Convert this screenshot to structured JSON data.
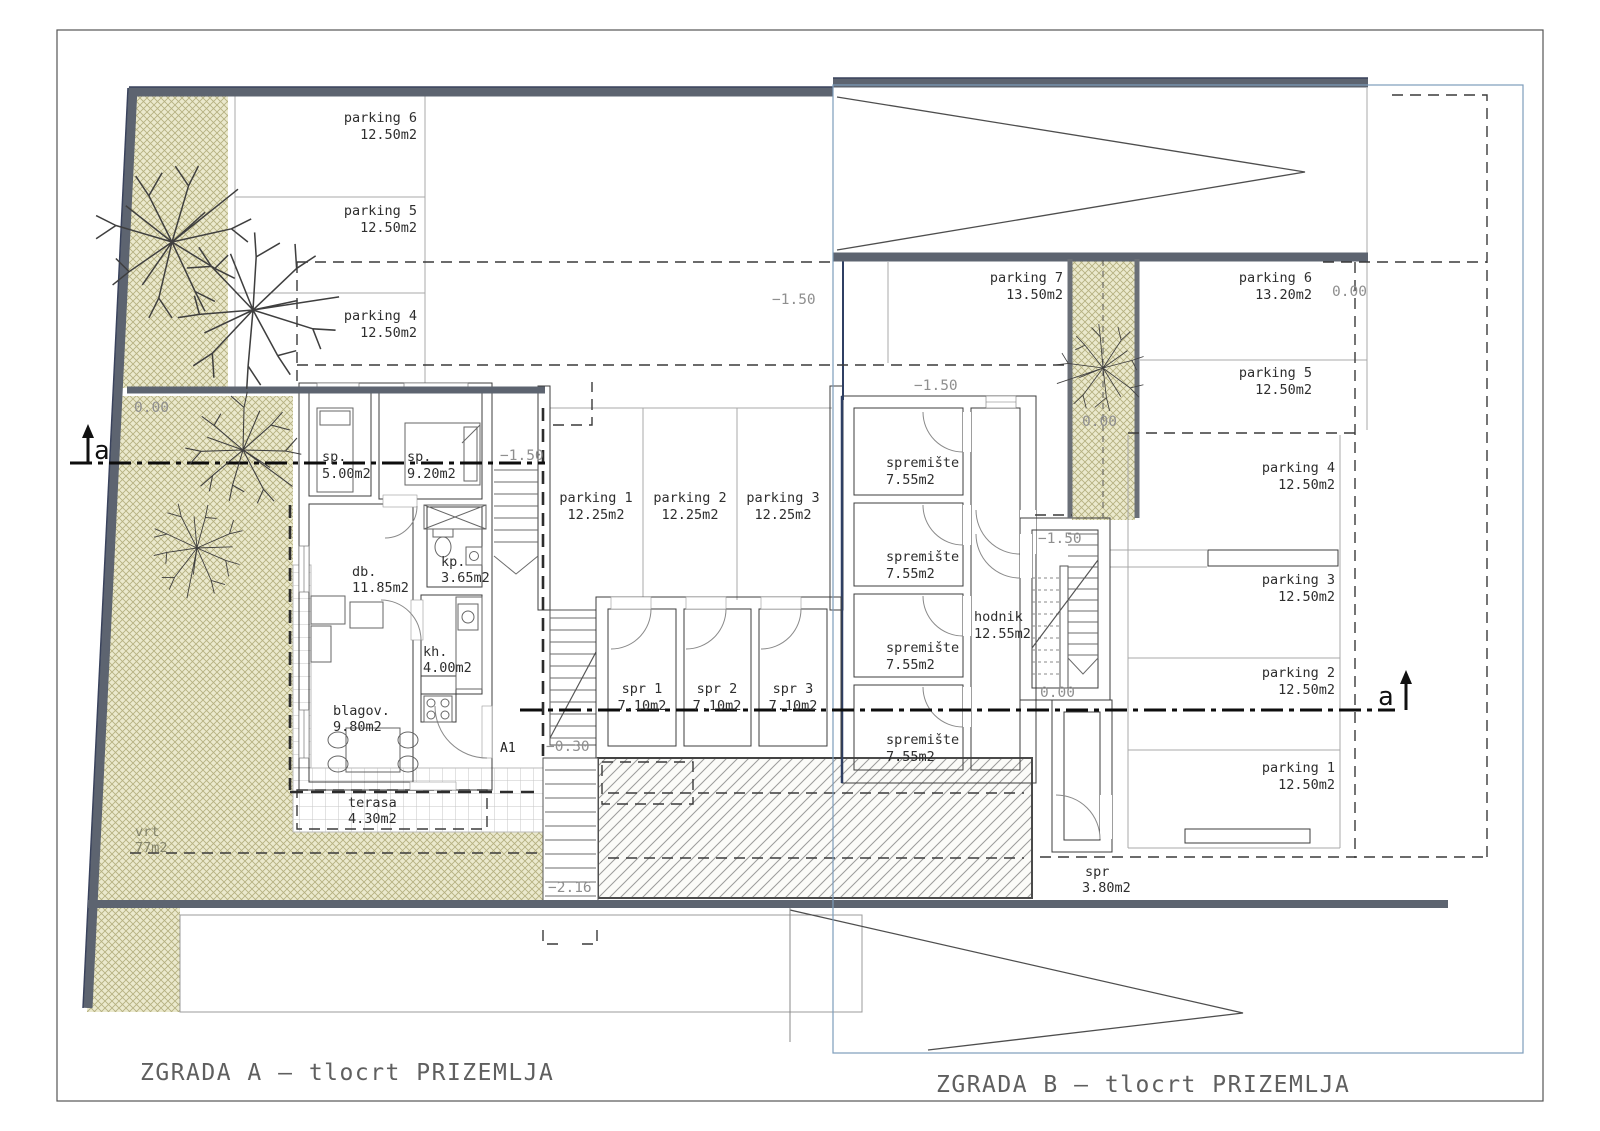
{
  "titles": {
    "building_a": "ZGRADA A — tlocrt PRIZEMLJA",
    "building_b": "ZGRADA B — tlocrt PRIZEMLJA"
  },
  "section_markers": {
    "label": "a"
  },
  "elevations": {
    "garden_a": "0.00",
    "court_b": "0.00",
    "ramp_top": "−1.50",
    "court_mid": "−1.50",
    "stair_a": "−1.50",
    "entry_b": "−1.50",
    "stair_b_base": "0.00",
    "landing_a": "−0.30",
    "stair_bottom": "−2.16",
    "street_b": "0.00"
  },
  "building_a": {
    "rooms": [
      {
        "name": "sp.",
        "area": "5.00m2"
      },
      {
        "name": "sp.",
        "area": "9.20m2"
      },
      {
        "name": "db.",
        "area": "11.85m2"
      },
      {
        "name": "kp.",
        "area": "3.65m2"
      },
      {
        "name": "kh.",
        "area": "4.00m2"
      },
      {
        "name": "blagov.",
        "area": "9.80m2"
      },
      {
        "name": "terasa",
        "area": "4.30m2"
      }
    ],
    "garden": {
      "name": "vrt",
      "area": "77m2"
    },
    "entrance_label": "A1",
    "parking": [
      {
        "name": "parking 6",
        "area": "12.50m2"
      },
      {
        "name": "parking 5",
        "area": "12.50m2"
      },
      {
        "name": "parking 4",
        "area": "12.50m2"
      },
      {
        "name": "parking 1",
        "area": "12.25m2"
      },
      {
        "name": "parking 2",
        "area": "12.25m2"
      },
      {
        "name": "parking 3",
        "area": "12.25m2"
      }
    ],
    "storage": [
      {
        "name": "spr 1",
        "area": "7.10m2"
      },
      {
        "name": "spr 2",
        "area": "7.10m2"
      },
      {
        "name": "spr 3",
        "area": "7.10m2"
      }
    ]
  },
  "building_b": {
    "storage": [
      {
        "name": "spremište",
        "area": "7.55m2"
      },
      {
        "name": "spremište",
        "area": "7.55m2"
      },
      {
        "name": "spremište",
        "area": "7.55m2"
      },
      {
        "name": "spremište",
        "area": "7.55m2"
      }
    ],
    "hallway": {
      "name": "hodnik",
      "area": "12.55m2"
    },
    "storage_small": {
      "name": "spr",
      "area": "3.80m2"
    },
    "parking": [
      {
        "name": "parking 7",
        "area": "13.50m2"
      },
      {
        "name": "parking 6",
        "area": "13.20m2"
      },
      {
        "name": "parking 5",
        "area": "12.50m2"
      },
      {
        "name": "parking 4",
        "area": "12.50m2"
      },
      {
        "name": "parking 3",
        "area": "12.50m2"
      },
      {
        "name": "parking 2",
        "area": "12.50m2"
      },
      {
        "name": "parking 1",
        "area": "12.50m2"
      }
    ]
  }
}
